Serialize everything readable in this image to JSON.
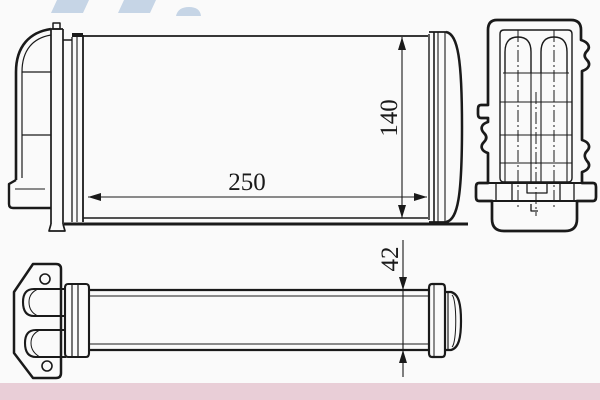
{
  "drawing": {
    "dim_width": "250",
    "dim_height": "140",
    "dim_pipe": "42"
  },
  "colors": {
    "line": "#1a1a1a",
    "background": "#fafafa",
    "watermark": "#c6d5e6",
    "footer": "#e9ced7"
  }
}
